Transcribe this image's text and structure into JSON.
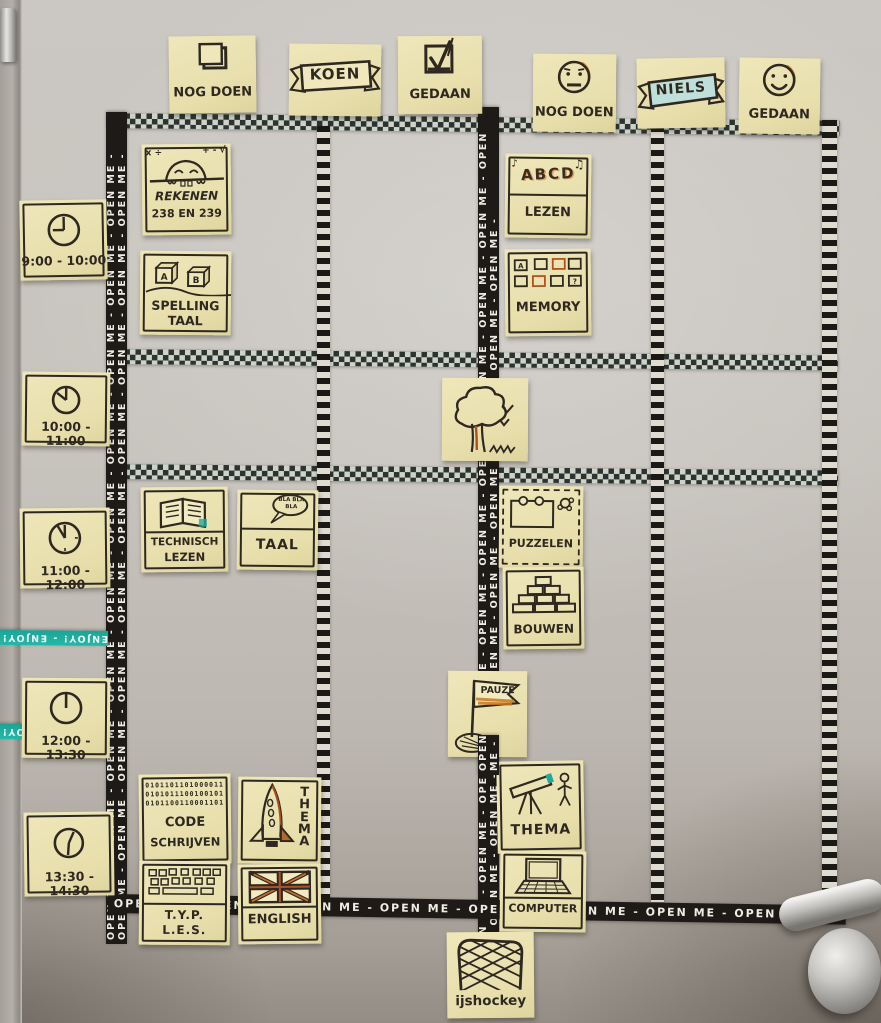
{
  "headers": {
    "koen": {
      "todo_label": "NOG DOEN",
      "name": "KOEN",
      "done_label": "GEDAAN"
    },
    "niels": {
      "todo_label": "NOG DOEN",
      "name": "NIELS",
      "done_label": "GEDAAN"
    }
  },
  "time_slots": [
    {
      "label": "9:00 - 10:00"
    },
    {
      "label": "10:00 - 11:00"
    },
    {
      "label": "11:00 - 12:00"
    },
    {
      "label": "12:00 - 13:30"
    },
    {
      "label": "13:30 - 14:30"
    }
  ],
  "notes": {
    "rekenen": {
      "title": "REKENEN",
      "pages": "238 EN 239",
      "symbols_left": "x ÷",
      "symbols_right": "+ - √"
    },
    "spelling": {
      "line1": "SPELLING",
      "line2": "TAAL",
      "block1": "A",
      "block2": "B"
    },
    "lezen": {
      "letters": "ABCD",
      "title": "LEZEN"
    },
    "memory": {
      "title": "MEMORY",
      "card1": "A",
      "card2": "?"
    },
    "technisch_lezen": {
      "line1": "TECHNISCH",
      "line2": "LEZEN"
    },
    "taal": {
      "title": "TAAL",
      "bubble": "BLA BLA BLA"
    },
    "puzzelen": {
      "title": "PUZZELEN"
    },
    "bouwen": {
      "title": "BOUWEN"
    },
    "pauze": {
      "title": "PAUZE"
    },
    "code": {
      "line1": "CODE",
      "line2": "SCHRIJVEN",
      "binary1": "0101101101000011",
      "binary2": "0101011100100101",
      "binary3": "0101100110001101"
    },
    "thema_koen": {
      "title": "THEMA"
    },
    "typles": {
      "line1": "T.Y.P.",
      "line2": "L.E.S."
    },
    "english": {
      "title": "ENGLISH"
    },
    "thema_niels": {
      "title": "THEMA"
    },
    "computer": {
      "title": "COMPUTER"
    },
    "ijshockey": {
      "title": "ijshockey"
    }
  },
  "tapes": {
    "open_me_repeat": "OPEN ME - OPEN ME - OPEN ME - OPEN ME - OPEN ME - OPEN ME - OPEN ME - OPEN ME - OPEN ME - OPEN ME - OPEN ME - OPEN ME - OPEN ME - OPEN ME - OPEN ME - OPEN ME - OPEN ME - OPEN ME - OPEN ME - OPEN ME -",
    "enjoy_repeat": "ENJOY! - ENJOY! - ENJOY! - ENJOY! - ENJOY! - ENJOY! - ENJOY! - ENJOY! - ENJOY! - ENJOY! - ENJOY! - ENJOY! - ENJOY! - ENJOY! -"
  },
  "icons": {
    "music_note_left": "♪",
    "music_note_right": "♫"
  },
  "colors": {
    "sticky": "#ece3b2",
    "ink": "#2e2820",
    "tape_black": "#1d1a17",
    "tape_teal": "#1fb0a1",
    "accent_orange": "#dd8a2f",
    "accent_red": "#a8501f",
    "accent_teal": "#27a79a"
  }
}
